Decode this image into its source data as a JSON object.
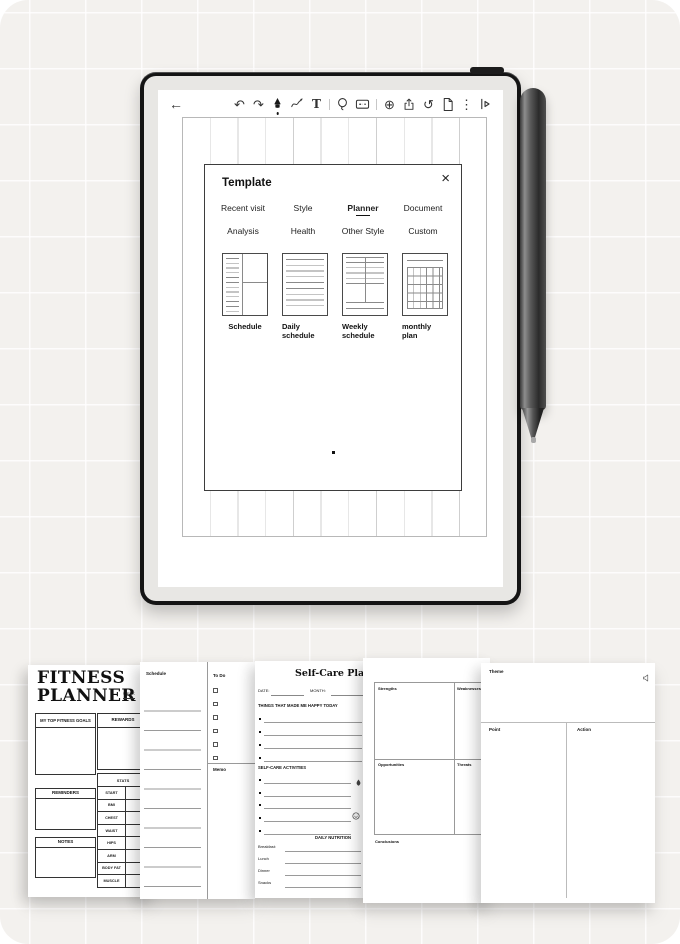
{
  "toolbar": {
    "back": "←",
    "undo": "↶",
    "redo": "↷",
    "text_tool": "T",
    "zoom_in": "⊕",
    "history": "↺",
    "more": "⋮"
  },
  "dialog": {
    "title": "Template",
    "close": "×",
    "tabs": [
      {
        "label": "Recent visit",
        "active": false
      },
      {
        "label": "Style",
        "active": false
      },
      {
        "label": "Planner",
        "active": true
      },
      {
        "label": "Document",
        "active": false
      },
      {
        "label": "Analysis",
        "active": false
      },
      {
        "label": "Health",
        "active": false
      },
      {
        "label": "Other Style",
        "active": false
      },
      {
        "label": "Custom",
        "active": false
      }
    ],
    "templates": [
      {
        "label": "Schedule"
      },
      {
        "label": "Daily schedule"
      },
      {
        "label": "Weekly schedule"
      },
      {
        "label": "monthly plan"
      }
    ]
  },
  "previews": {
    "fitness": {
      "title_line1": "FITNESS",
      "title_line2": "PLANNER",
      "week_label": "WEEK",
      "goals_header": "MY TOP FITNESS GOALS",
      "rewards_header": "REWARDS",
      "reminders_header": "REMINDERS",
      "notes_header": "NOTES",
      "stats_header": "STATS",
      "measurement_rows": [
        "START",
        "BMI",
        "CHEST",
        "WAIST",
        "HIPS",
        "ARM",
        "BODY FAT",
        "MUSCLE"
      ]
    },
    "schedule_todo": {
      "schedule_header": "Schedule",
      "todo_header": "To Do",
      "memo_header": "Memo"
    },
    "selfcare": {
      "title": "Self-Care Planner",
      "date_label": "DATE:",
      "month_label": "MONTH:",
      "happy_header": "THINGS THAT MADE ME HAPPY TODAY",
      "activities_header": "SELF-CARE ACTIVITIES",
      "nutrition_header": "DAILY NUTRITION",
      "meals": [
        "Breakfast:",
        "Lunch",
        "Dinner",
        "Snacks"
      ]
    },
    "swot": {
      "strengths": "Strengths",
      "weaknesses": "Weaknesses",
      "opportunities": "Opportunities",
      "threats": "Threats",
      "conclusions": "Conclusions"
    },
    "theme": {
      "title": "Theme",
      "point_header": "Point",
      "action_header": "Action"
    }
  },
  "colors": {
    "background": "#f3f1ee",
    "device_frame": "#141414",
    "bezel": "#e8e7e4",
    "ink": "#111111"
  }
}
